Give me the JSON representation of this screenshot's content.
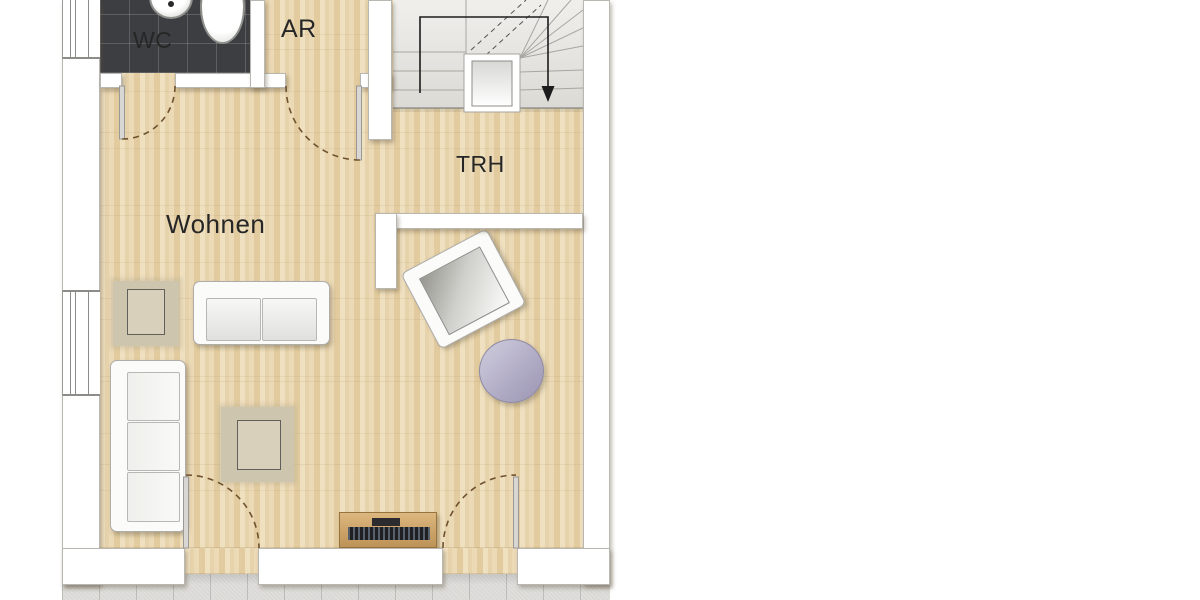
{
  "plan": {
    "type": "architectural-floor-plan",
    "rooms": [
      {
        "id": "wc",
        "label": "WC"
      },
      {
        "id": "ar",
        "label": "AR"
      },
      {
        "id": "trh",
        "label": "TRH"
      },
      {
        "id": "wohnen",
        "label": "Wohnen"
      }
    ],
    "furniture": [
      "sofa-two-seater",
      "sofa-three-seater",
      "armchair",
      "round-side-table",
      "area-rug-small",
      "area-rug-large",
      "tv-sideboard",
      "staircase",
      "wc-sink",
      "wc-toilet"
    ],
    "colors": {
      "background": "#ffffff",
      "wall": "#ffffff",
      "wall_edge": "#b9b7b2",
      "wood_floor": "#ead8b4",
      "wood_plank_dark": "#e2cc9f",
      "wc_tiles": "#3d3e41",
      "terrace_tiles": "#dad9d6",
      "stair_tread": "#e9e8e4",
      "walk_line": "#1c1c1c",
      "door_swing": "#6e512f",
      "rug": "#cdc5ae",
      "sideboard": "#c59a62",
      "tv_screen": "#202023",
      "round_table": "#b2adc6",
      "label_text": "#262626"
    }
  }
}
